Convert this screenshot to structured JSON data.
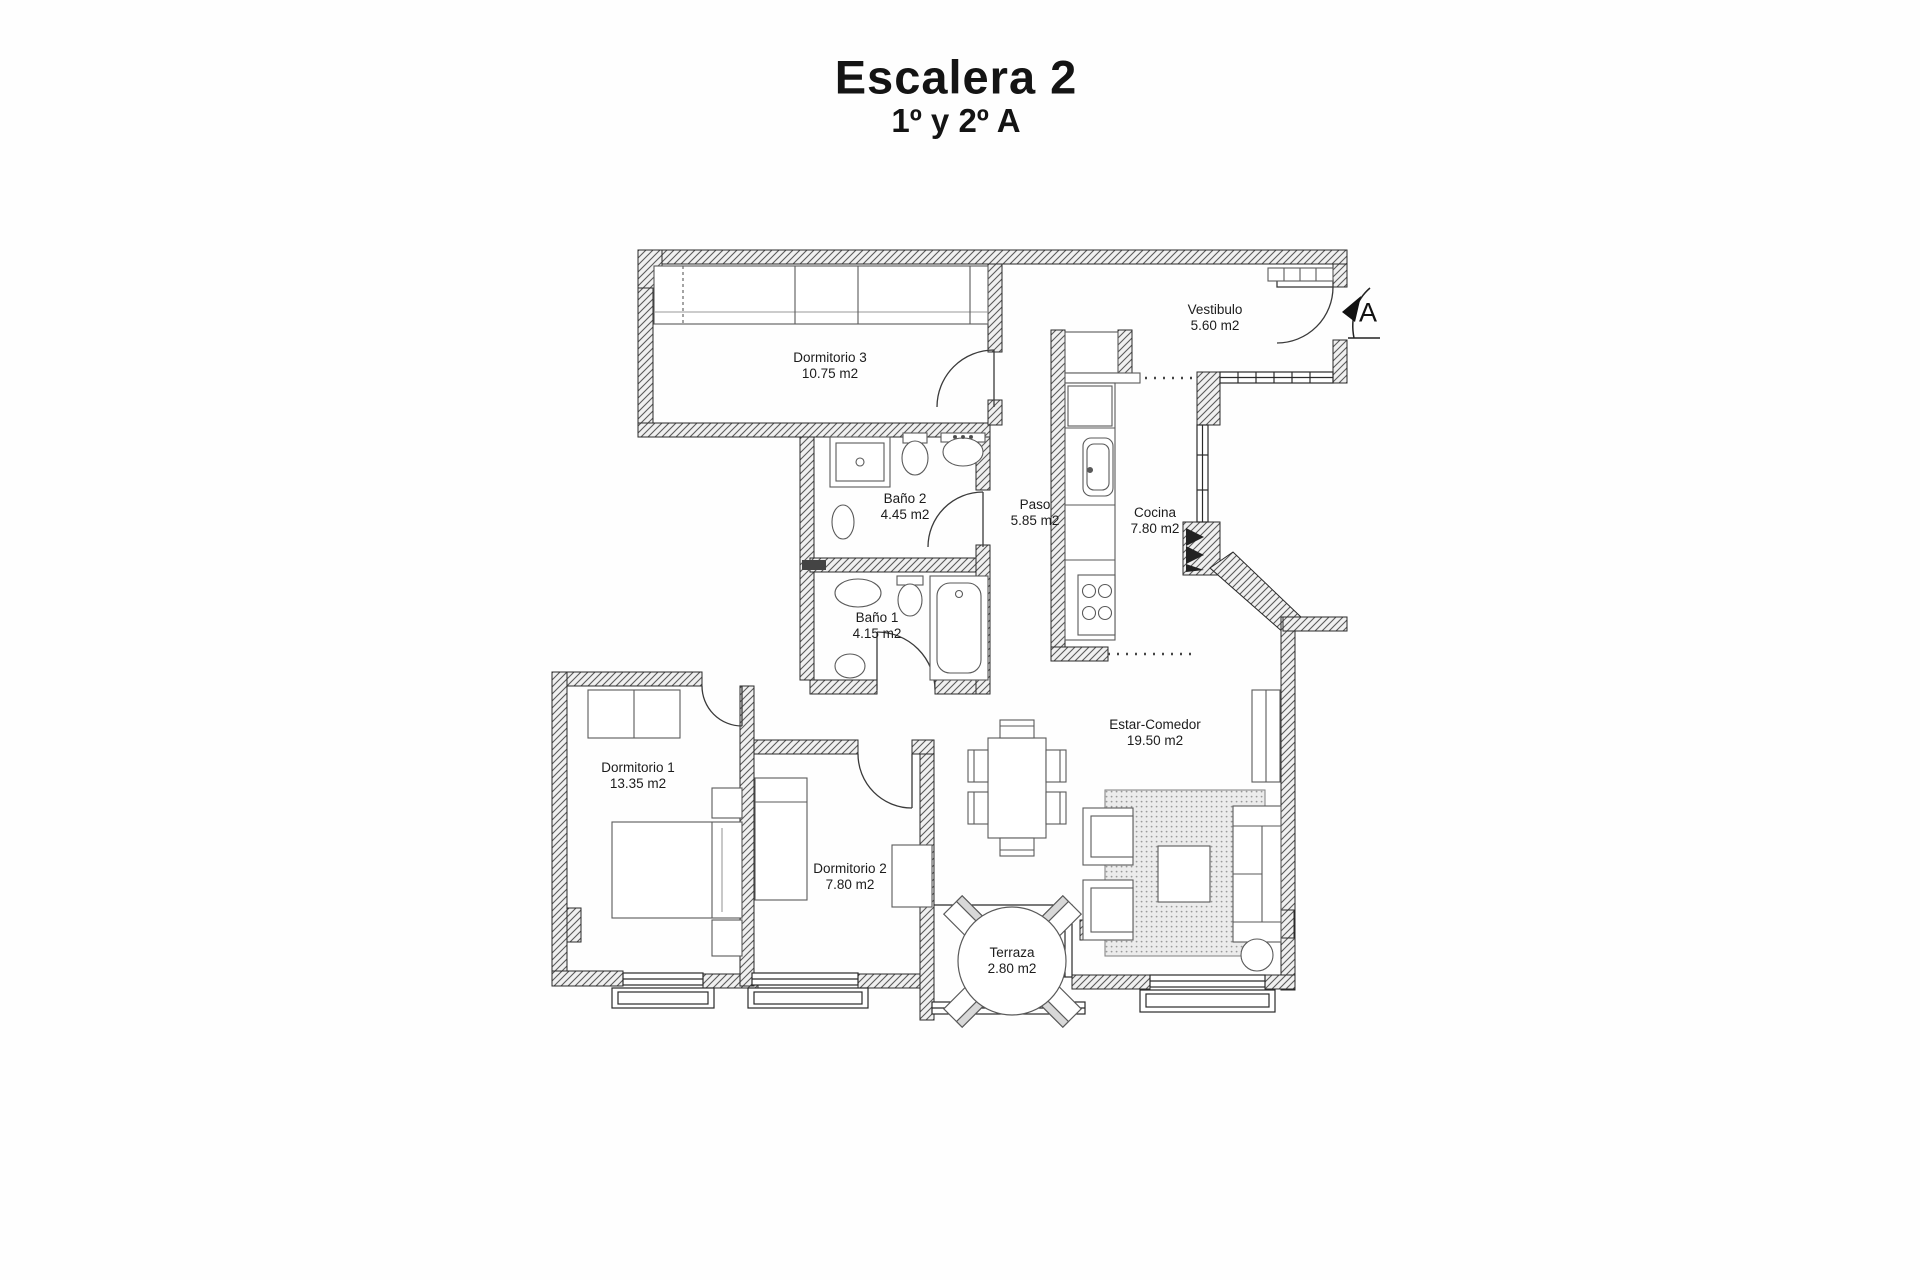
{
  "header": {
    "title": "Escalera 2",
    "subtitle": "1º y 2º A"
  },
  "entrance": {
    "marker": "A"
  },
  "rooms": [
    {
      "id": "dormitorio-3",
      "name": "Dormitorio 3",
      "area": "10.75 m2"
    },
    {
      "id": "vestibulo",
      "name": "Vestibulo",
      "area": "5.60 m2"
    },
    {
      "id": "bano-2",
      "name": "Baño 2",
      "area": "4.45 m2"
    },
    {
      "id": "paso",
      "name": "Paso",
      "area": "5.85 m2"
    },
    {
      "id": "cocina",
      "name": "Cocina",
      "area": "7.80 m2"
    },
    {
      "id": "bano-1",
      "name": "Baño 1",
      "area": "4.15 m2"
    },
    {
      "id": "estar-comedor",
      "name": "Estar-Comedor",
      "area": "19.50 m2"
    },
    {
      "id": "dormitorio-1",
      "name": "Dormitorio 1",
      "area": "13.35 m2"
    },
    {
      "id": "dormitorio-2",
      "name": "Dormitorio 2",
      "area": "7.80 m2"
    },
    {
      "id": "terraza",
      "name": "Terraza",
      "area": "2.80 m2"
    }
  ]
}
